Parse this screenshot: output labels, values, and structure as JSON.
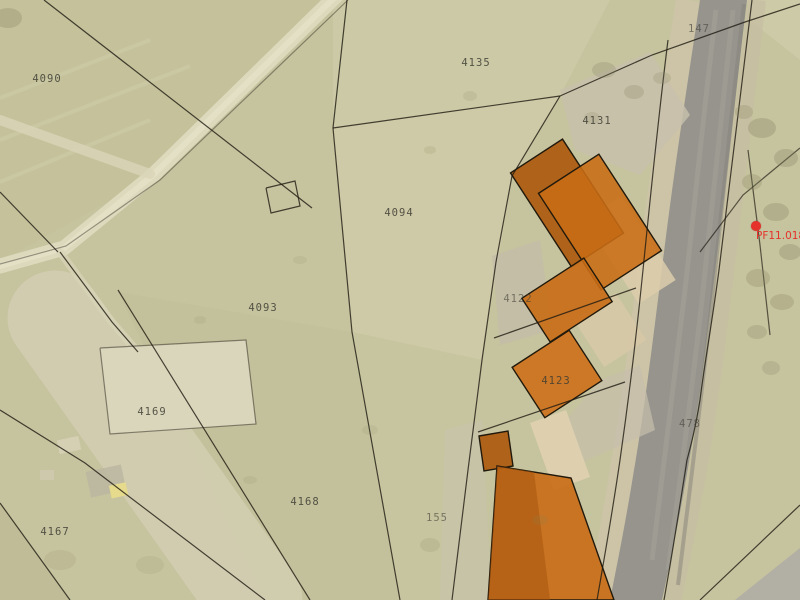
{
  "parcel_labels": [
    {
      "id": "4090",
      "text": "4090"
    },
    {
      "id": "4135",
      "text": "4135"
    },
    {
      "id": "4131",
      "text": "4131"
    },
    {
      "id": "4094",
      "text": "4094"
    },
    {
      "id": "4093",
      "text": "4093"
    },
    {
      "id": "4122",
      "text": "4122"
    },
    {
      "id": "4123",
      "text": "4123"
    },
    {
      "id": "4169",
      "text": "4169"
    },
    {
      "id": "4168",
      "text": "4168"
    },
    {
      "id": "155",
      "text": "155"
    },
    {
      "id": "4167",
      "text": "4167"
    },
    {
      "id": "478",
      "text": "478"
    },
    {
      "id": "147",
      "text": "147"
    }
  ],
  "marker": {
    "label": "PF11.018",
    "color": "#e5322a"
  },
  "colors": {
    "building_highlight": "#c86c15",
    "building_highlight_dark": "#ad5a0e",
    "building_unhighlighted": "#dccdab",
    "road_asphalt": "#96948d",
    "parcel_line": "#1e1a12",
    "parcel_label_text": "#3e3d33",
    "marker_red": "#e5322a",
    "field_base": "#c6c39f"
  }
}
